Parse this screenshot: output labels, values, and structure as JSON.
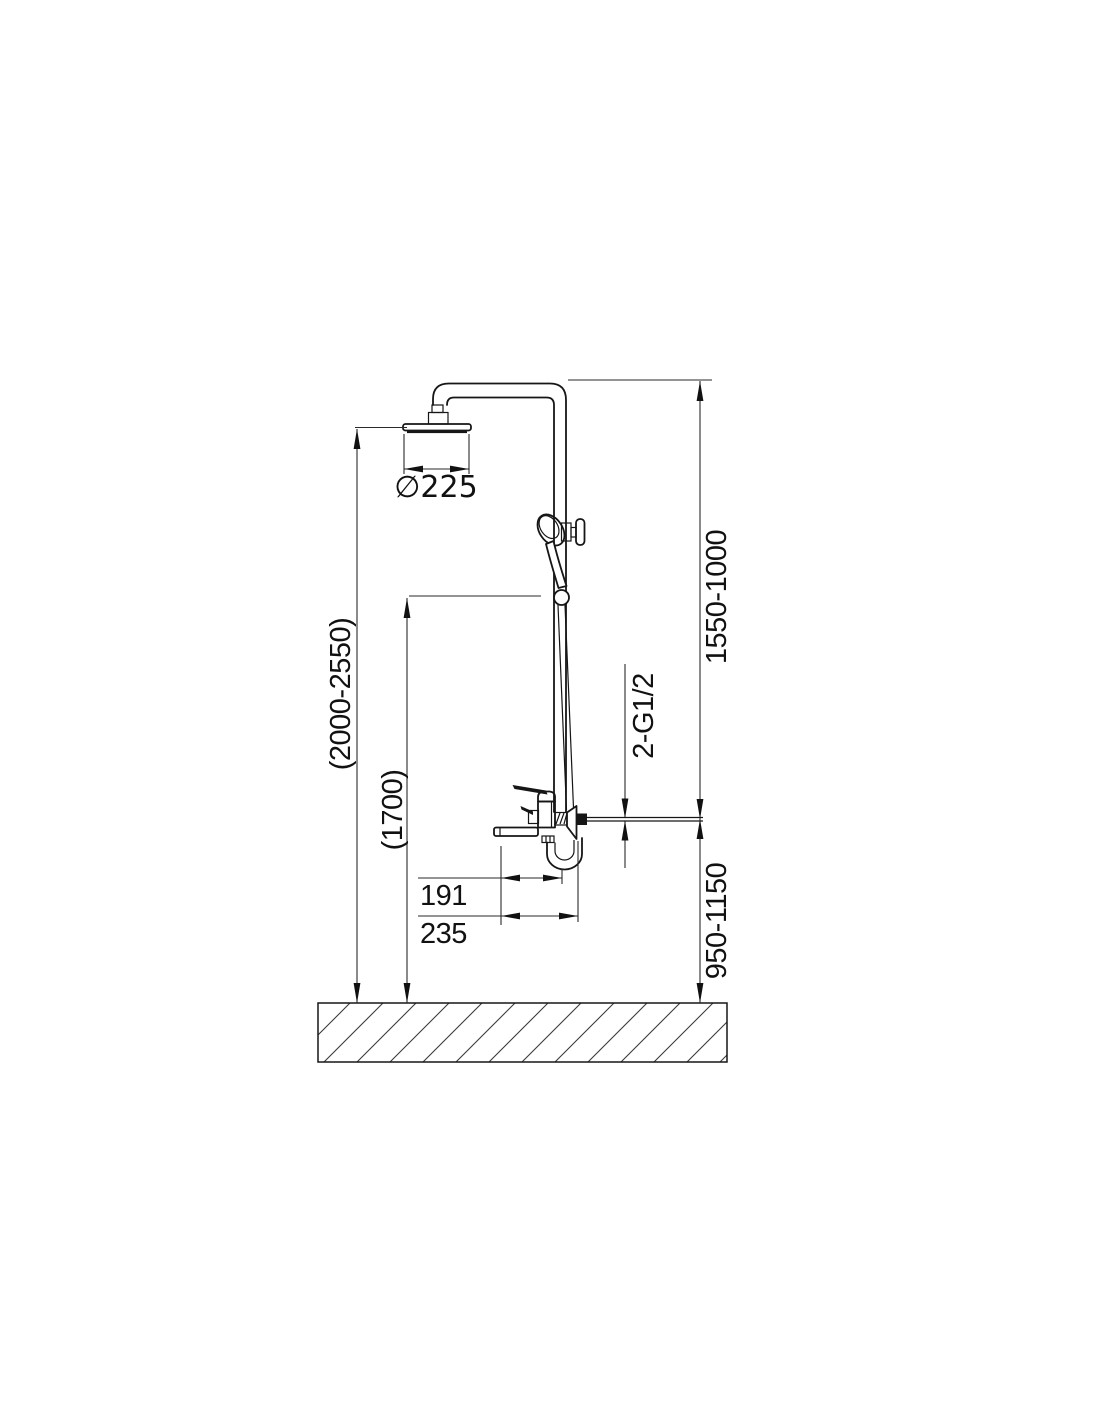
{
  "labels": {
    "head_diameter": "∅225",
    "overall_height": "(2000-2550)",
    "handshower_height": "(1700)",
    "column_adjust_range": "1550-1000",
    "inlet_thread": "2-G1/2",
    "inlet_height": "950-1150",
    "spout_offset": "191",
    "wall_offset": "235"
  },
  "colors": {
    "line": "#161616",
    "dimension_line": "#2a2a2a",
    "background": "#ffffff"
  }
}
